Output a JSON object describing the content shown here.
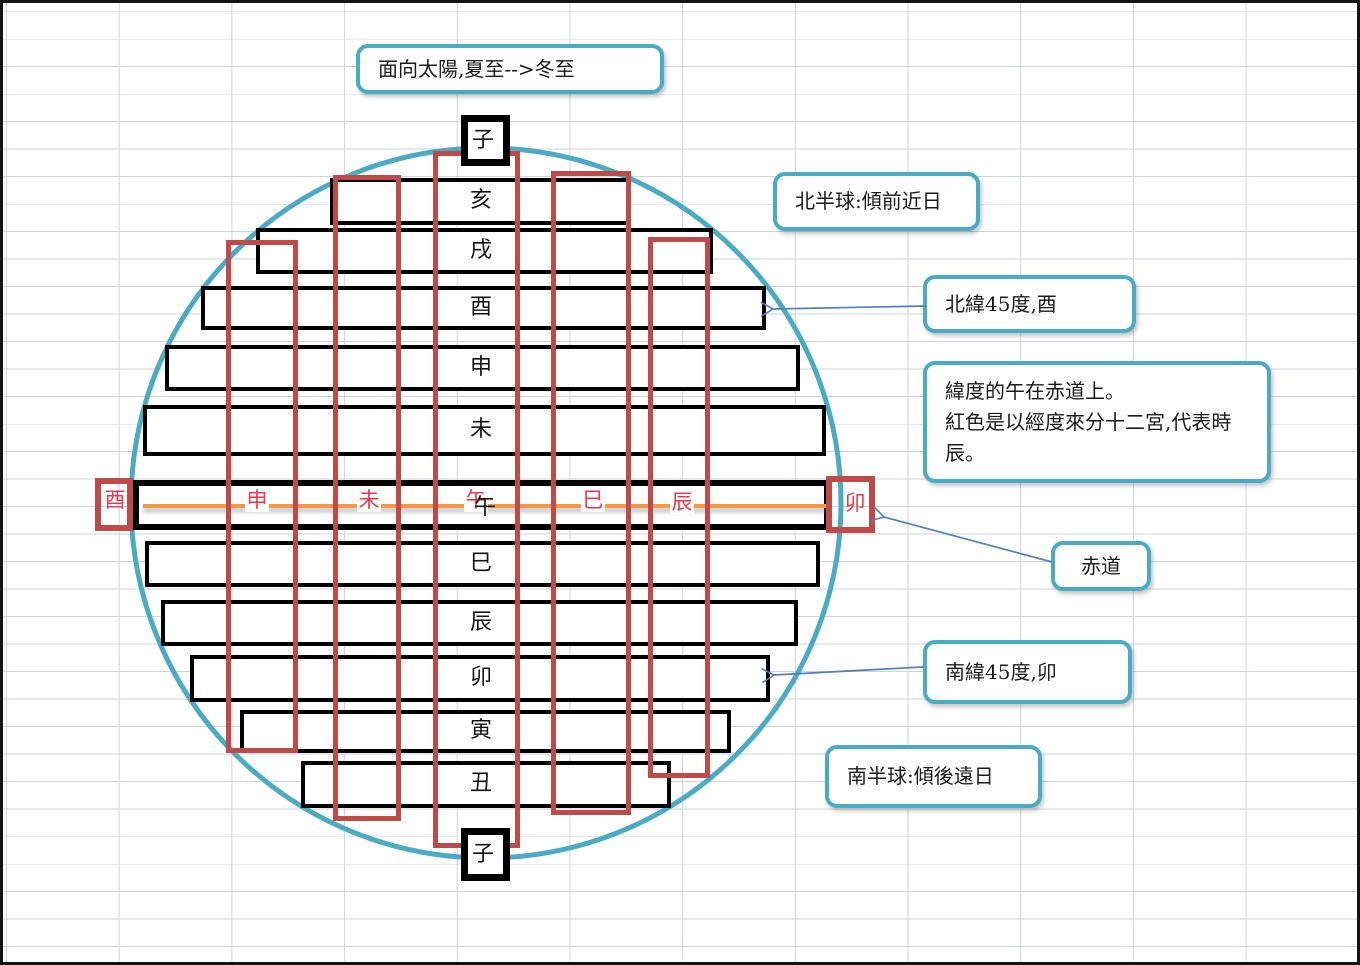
{
  "app": {
    "kind": "excel-sheet-astronomy-diagram"
  },
  "callouts": {
    "top": "面向太陽,夏至-->冬至",
    "north_hemisphere": "北半球:傾前近日",
    "north_lat45": "北緯45度,酉",
    "note_line1": "緯度的午在赤道上。",
    "note_line2": "紅色是以經度來分十二宮,代表時辰。",
    "equator": "赤道",
    "south_lat45": "南緯45度,卯",
    "south_hemisphere": "南半球:傾後遠日"
  },
  "diagram": {
    "top_box_label": "子",
    "bottom_box_label": "子",
    "bar_labels": [
      "亥",
      "戌",
      "酉",
      "申",
      "未",
      "巳",
      "辰",
      "卯",
      "寅",
      "丑"
    ],
    "equator_bar_label": "午",
    "red_equator_labels": [
      "酉",
      "申",
      "未",
      "午",
      "巳",
      "辰",
      "卯"
    ],
    "colors": {
      "circle_teal": "#4aabc5",
      "bar_border": "#000000",
      "red_rect": "#be4b48",
      "red_text": "#e9384f",
      "equator_orange": "#f79646",
      "arrow_blue": "#4f81bd",
      "gridline": "#cdd3e2"
    }
  }
}
